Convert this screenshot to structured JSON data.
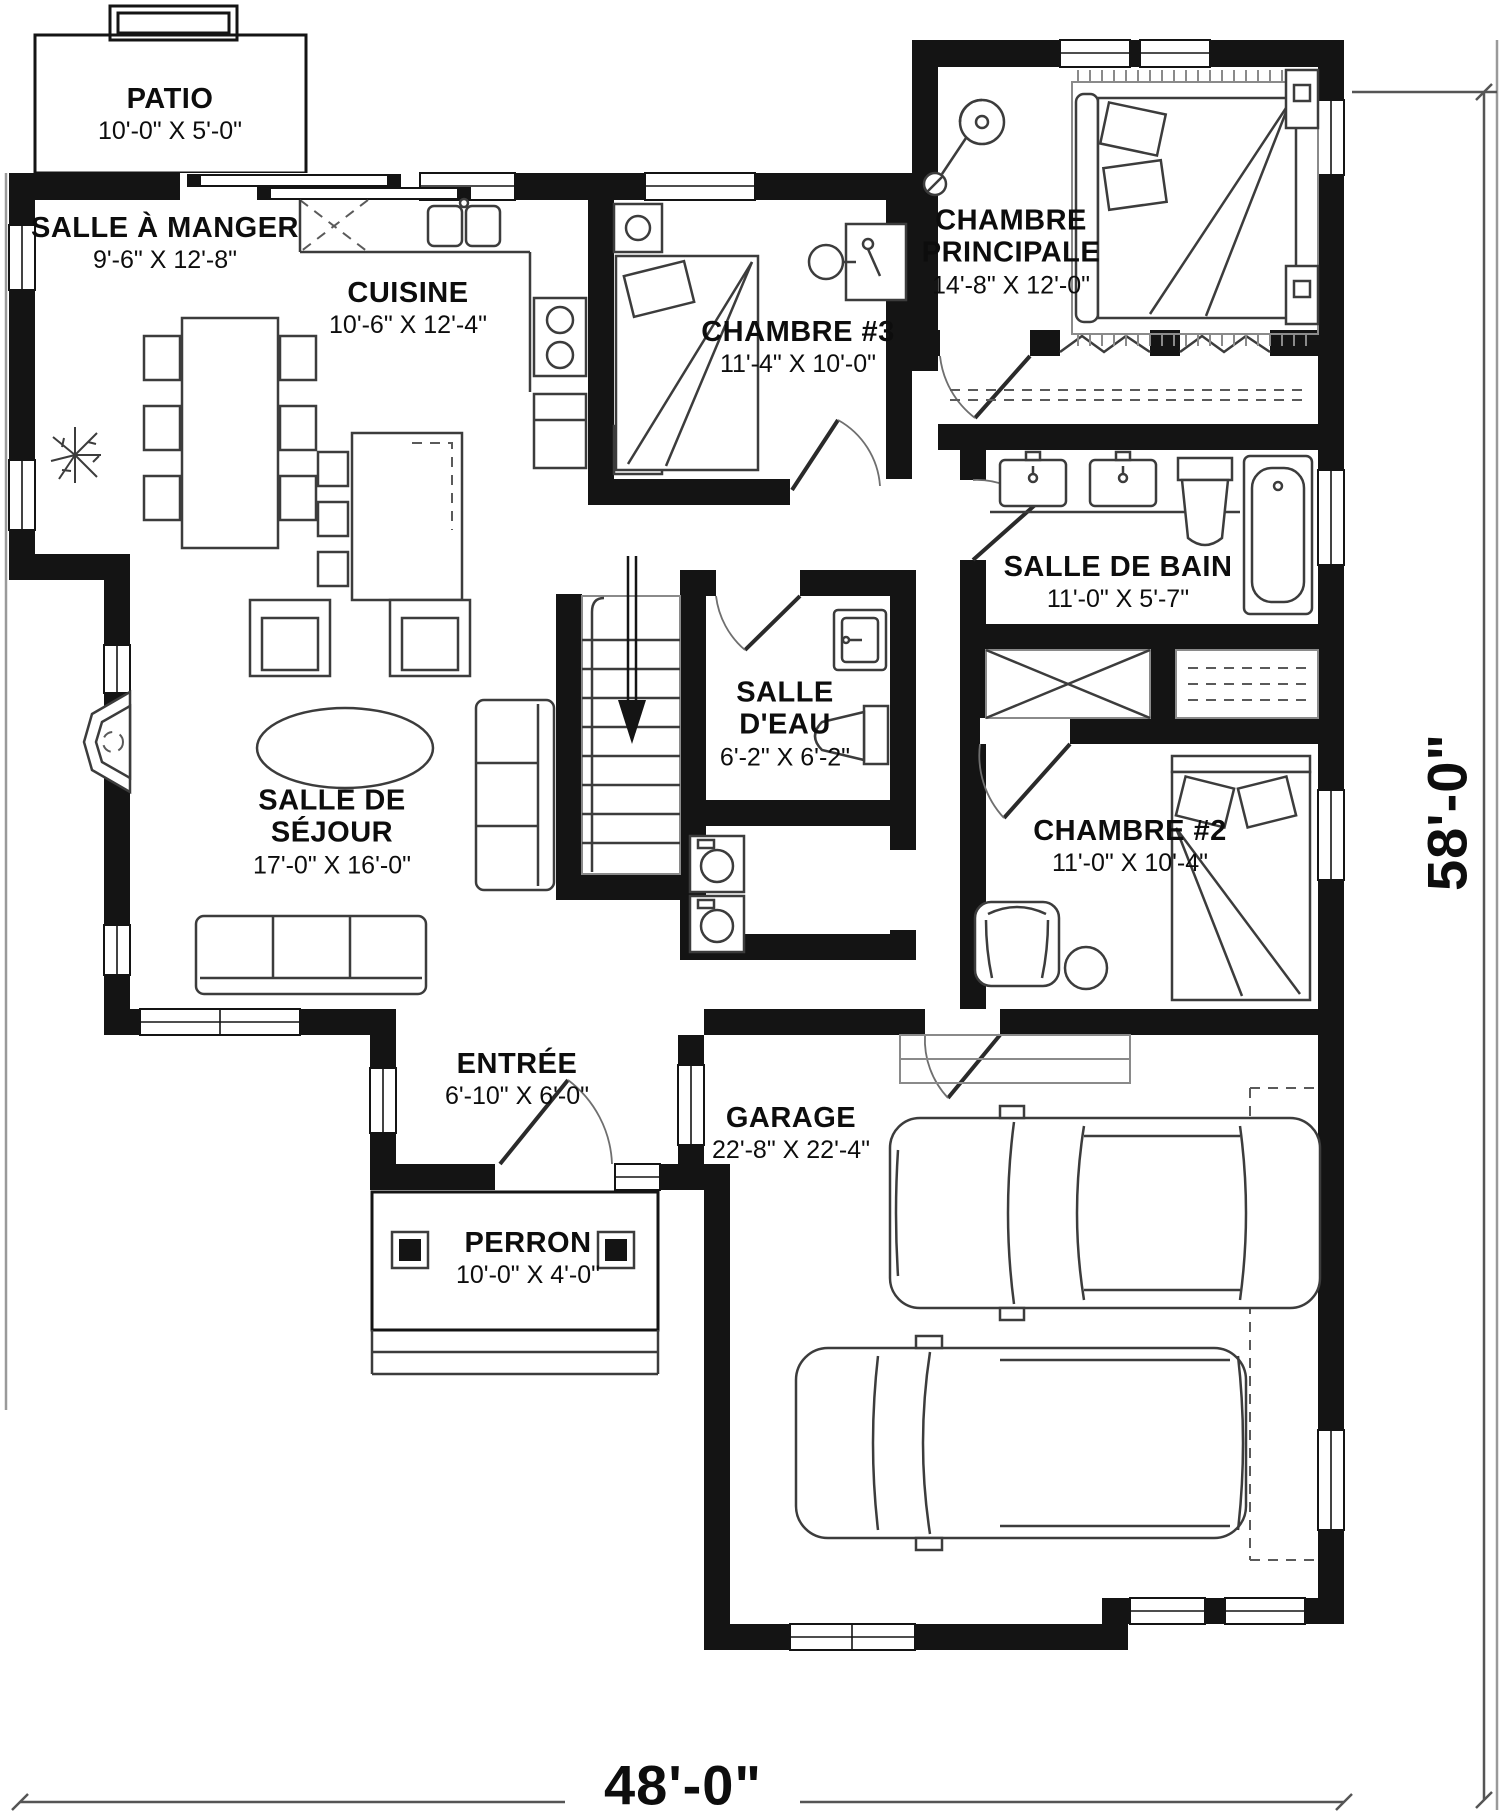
{
  "plan": {
    "type": "floor-plan",
    "language": "fr",
    "rooms": [
      {
        "id": "patio",
        "name": "PATIO",
        "dims": "10'-0\" X 5'-0\""
      },
      {
        "id": "salle-a-manger",
        "name": "SALLE À MANGER",
        "dims": "9'-6\" X 12'-8\""
      },
      {
        "id": "cuisine",
        "name": "CUISINE",
        "dims": "10'-6\" X 12'-4\""
      },
      {
        "id": "chambre-3",
        "name": "CHAMBRE #3",
        "dims": "11'-4\" X 10'-0\""
      },
      {
        "id": "chambre-principale",
        "name": "CHAMBRE PRINCIPALE",
        "dims": "14'-8\" X 12'-0\""
      },
      {
        "id": "salle-de-bain",
        "name": "SALLE DE BAIN",
        "dims": "11'-0\" X 5'-7\""
      },
      {
        "id": "salle-d-eau",
        "name": "SALLE D'EAU",
        "dims": "6'-2\" X 6'-2\""
      },
      {
        "id": "salle-de-sejour",
        "name": "SALLE DE SÉJOUR",
        "dims": "17'-0\" X 16'-0\""
      },
      {
        "id": "chambre-2",
        "name": "CHAMBRE #2",
        "dims": "11'-0\" X 10'-4\""
      },
      {
        "id": "entree",
        "name": "ENTRÉE",
        "dims": "6'-10\" X 6'-0\""
      },
      {
        "id": "garage",
        "name": "GARAGE",
        "dims": "22'-8\" X 22'-4\""
      },
      {
        "id": "perron",
        "name": "PERRON",
        "dims": "10'-0\" X 4'-0\""
      }
    ],
    "overall_dimensions": {
      "width": "48'-0\"",
      "height": "58'-0\""
    }
  }
}
